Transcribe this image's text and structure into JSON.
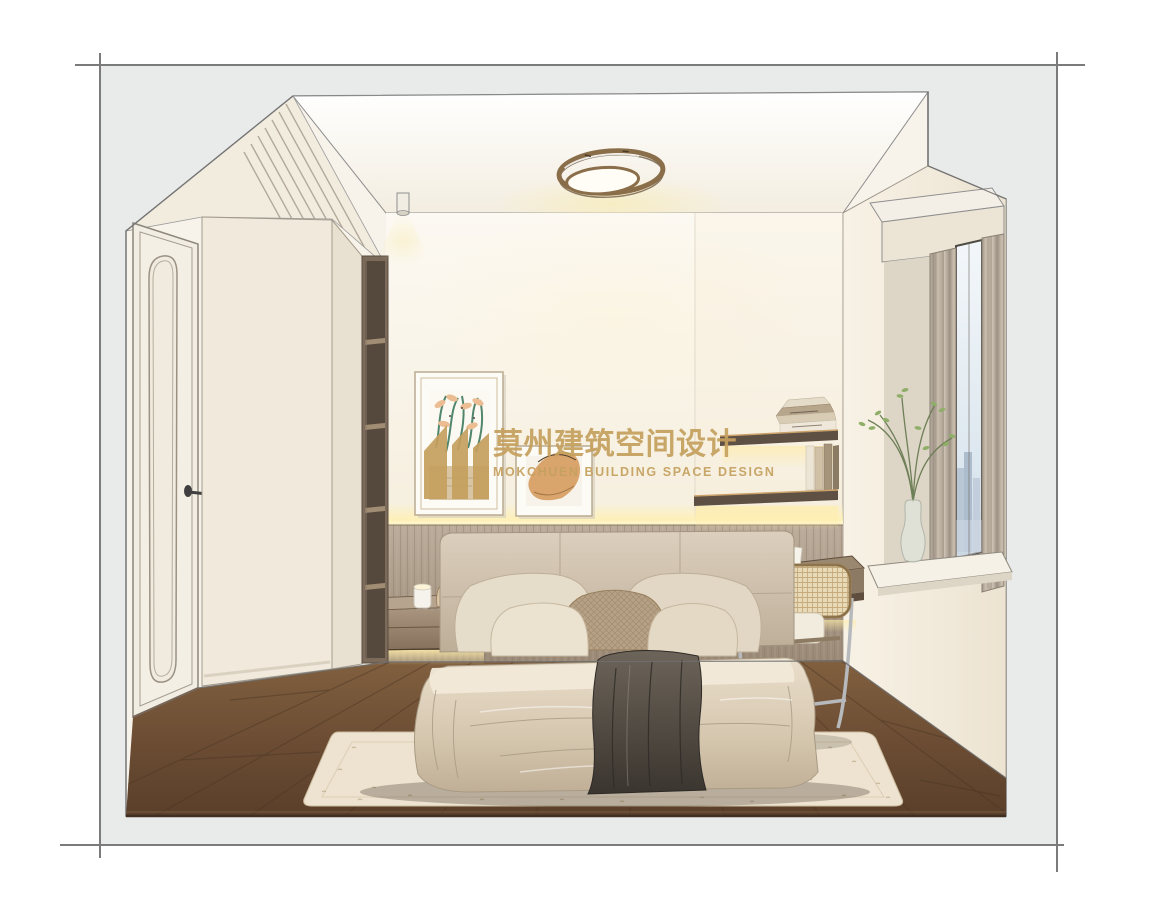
{
  "image": {
    "type": "interior design rendering",
    "room": "bedroom",
    "style": "hand-drawn sketch style render, cream and wood tones"
  },
  "watermark": {
    "logo": "mokchuen-building-logo",
    "title_cn": "莫州建筑空间设计",
    "subtitle_en": "MOKCHUEN BUILDING SPACE DESIGN",
    "color": "#C5A05E"
  },
  "scene": {
    "objects": [
      "interior-door",
      "wardrobe",
      "open-shelving",
      "wall-art-large",
      "wall-art-small",
      "ceiling-light",
      "spotlight",
      "wall-shelf-upper",
      "wall-shelf-lower",
      "books",
      "bed",
      "pillows",
      "throw-blanket",
      "nightstand",
      "candle-cup",
      "decor-vase",
      "alarm-clock",
      "desk",
      "open-book",
      "rattan-chair",
      "window",
      "curtains",
      "plant-vase",
      "city-view",
      "area-rug",
      "wood-floor",
      "wall-paneling",
      "led-strip-light"
    ]
  },
  "palette": {
    "page_background": "#FFFFFF",
    "mat_background": "#E9EAEA",
    "frame_line": "#7B7B7B",
    "wall_cream": "#F6F1E6",
    "wood_floor": "#6E4F38",
    "wall_paneling": "#AD9D8C",
    "bedding_beige": "#D9CDBA",
    "throw_dark": "#4A443D",
    "glow_warm": "#FFF0B8",
    "watermark_gold": "#C5A05E"
  }
}
